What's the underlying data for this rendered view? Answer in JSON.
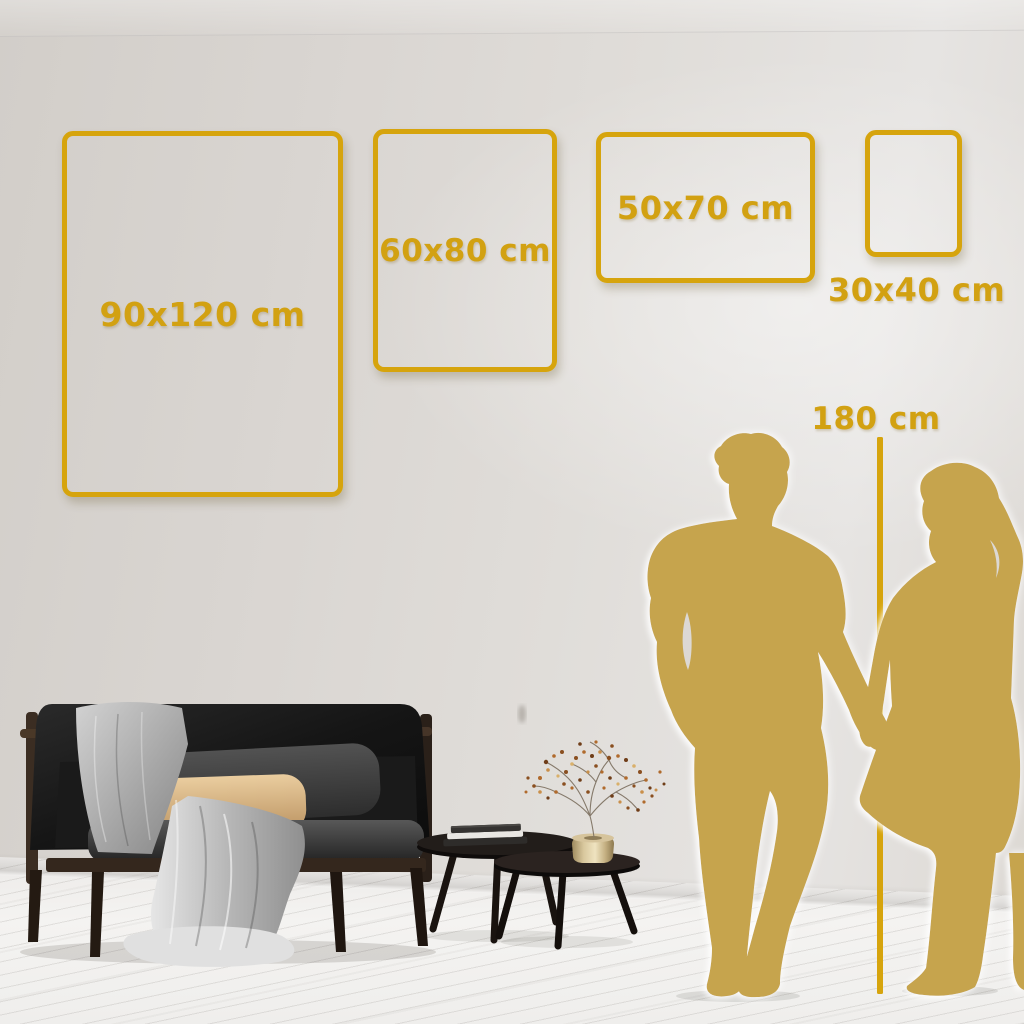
{
  "scene": {
    "type": "wall-art-size-guide",
    "colors": {
      "accent_gold": "#D6A40D",
      "silhouette_gold": "#C6A44E",
      "wall": "#DDD9D5",
      "floor": "#F3F2F0",
      "sofa_dark": "#161616",
      "pillow_tan": "#D9B585",
      "blanket_gray": "#BDBDBD",
      "vase_brass": "#D8C69C"
    }
  },
  "size_guide": {
    "frames": [
      {
        "id": "90x120",
        "label": "90x120 cm",
        "width_cm": 90,
        "height_cm": 120,
        "orientation": "portrait",
        "label_placement": "inside"
      },
      {
        "id": "60x80",
        "label": "60x80 cm",
        "width_cm": 60,
        "height_cm": 80,
        "orientation": "portrait",
        "label_placement": "inside"
      },
      {
        "id": "50x70",
        "label": "50x70 cm",
        "width_cm": 50,
        "height_cm": 70,
        "orientation": "landscape",
        "label_placement": "inside"
      },
      {
        "id": "30x40",
        "label": "30x40 cm",
        "width_cm": 30,
        "height_cm": 40,
        "orientation": "portrait",
        "label_placement": "below"
      }
    ],
    "height_reference": {
      "label": "180 cm",
      "height_cm": 180
    }
  }
}
